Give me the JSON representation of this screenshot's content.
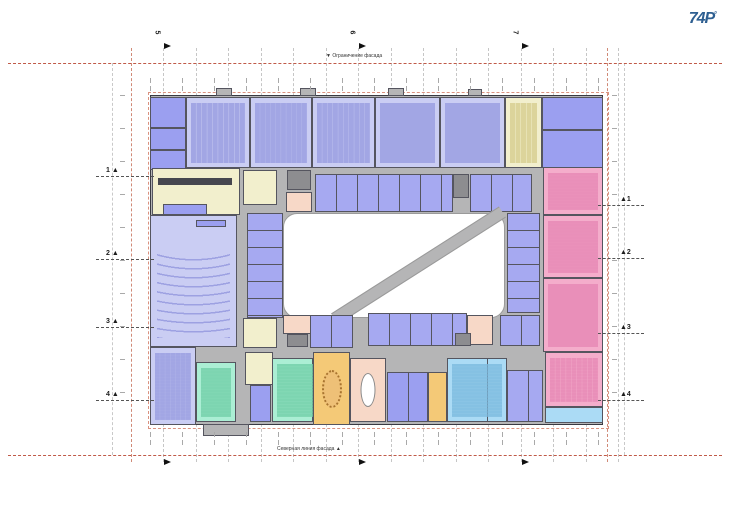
{
  "logo": {
    "text": "74P",
    "sup": "°",
    "color": "#2e5f91"
  },
  "labels": {
    "top_facade": "Ограничение фасада",
    "bottom_facade": "Северная линия фасада"
  },
  "palette": {
    "base": "#b5b5b6",
    "wall": "#55555f",
    "court": "#ffffff",
    "lavender": "#cacdf3",
    "lavDesk": "#989ce0",
    "purple": "#9b9ff0",
    "office": "#a6a9f1",
    "yellow": "#f2efcd",
    "yellowSpeck": "#d6cd8e",
    "salmon": "#f7d8c7",
    "pink": "#f4adcb",
    "pinkDesk": "#e687b4",
    "green": "#abeed4",
    "greenSpeck": "#72cfa8",
    "orange": "#f4c977",
    "blue": "#abdbf5",
    "blueSpeck": "#7cbade",
    "core": "#8d8d90",
    "darkbar": "#47474f",
    "redline": "#c05a48",
    "redlight": "#d08a77",
    "grid": "#c6c6c6",
    "marker": "#1c1c1c"
  },
  "grid": {
    "v_gray": [
      163,
      196,
      228,
      261,
      293,
      326,
      358,
      391,
      423,
      456,
      488,
      521,
      553,
      586,
      618
    ],
    "v_red": [
      131,
      607
    ],
    "v_outer": [
      112,
      624
    ],
    "h_red": [
      63,
      455
    ],
    "red_rect": {
      "x": 148,
      "y": 92,
      "w": 459,
      "h": 335
    },
    "tick_strips_h": [
      {
        "x": 150,
        "y": 78,
        "w": 455
      },
      {
        "x": 150,
        "y": 86,
        "w": 455
      },
      {
        "x": 150,
        "y": 432,
        "w": 455
      },
      {
        "x": 150,
        "y": 440,
        "w": 455
      }
    ],
    "tick_strips_v": [
      {
        "x": 120,
        "y": 95,
        "h": 330
      },
      {
        "x": 612,
        "y": 95,
        "h": 330
      }
    ]
  },
  "markers": {
    "left": [
      {
        "n": "1",
        "y": 176
      },
      {
        "n": "2",
        "y": 259
      },
      {
        "n": "3",
        "y": 327
      },
      {
        "n": "4",
        "y": 400
      }
    ],
    "right": [
      {
        "n": "1",
        "y": 205
      },
      {
        "n": "2",
        "y": 258
      },
      {
        "n": "3",
        "y": 333
      },
      {
        "n": "4",
        "y": 400
      }
    ],
    "top": [
      {
        "n": "5",
        "x": 163
      },
      {
        "n": "6",
        "x": 358
      },
      {
        "n": "7",
        "x": 521
      }
    ],
    "bottom": [
      {
        "x": 163
      },
      {
        "x": 358
      },
      {
        "x": 521
      }
    ]
  },
  "plan": {
    "rooms": [
      {
        "name": "building-base",
        "x": 150,
        "y": 95,
        "w": 453,
        "h": 330,
        "c": "base",
        "cls": "heavy"
      },
      {
        "name": "porch",
        "x": 216,
        "y": 88,
        "w": 16,
        "h": 8,
        "c": "base",
        "cls": "outline"
      },
      {
        "name": "porch",
        "x": 300,
        "y": 88,
        "w": 16,
        "h": 8,
        "c": "base",
        "cls": "outline"
      },
      {
        "name": "porch",
        "x": 388,
        "y": 88,
        "w": 16,
        "h": 8,
        "c": "base",
        "cls": "outline"
      },
      {
        "name": "porch",
        "x": 468,
        "y": 89,
        "w": 14,
        "h": 7,
        "c": "base",
        "cls": "outline"
      },
      {
        "name": "porch",
        "x": 203,
        "y": 424,
        "w": 46,
        "h": 12,
        "c": "base",
        "cls": "outline"
      },
      {
        "name": "room-nw",
        "x": 150,
        "y": 97,
        "w": 36,
        "h": 31,
        "c": "purple",
        "cls": "outline"
      },
      {
        "name": "room-nw",
        "x": 150,
        "y": 128,
        "w": 36,
        "h": 22,
        "c": "purple",
        "cls": "outline"
      },
      {
        "name": "room-nw",
        "x": 150,
        "y": 150,
        "w": 36,
        "h": 20,
        "c": "purple",
        "cls": "outline"
      },
      {
        "name": "classroom",
        "x": 186,
        "y": 97,
        "w": 64,
        "h": 71,
        "c": "lavender",
        "cls": "outline desks",
        "dk": "lavDesk"
      },
      {
        "name": "classroom",
        "x": 250,
        "y": 97,
        "w": 62,
        "h": 71,
        "c": "lavender",
        "cls": "outline desks",
        "dk": "lavDesk"
      },
      {
        "name": "classroom",
        "x": 312,
        "y": 97,
        "w": 63,
        "h": 71,
        "c": "lavender",
        "cls": "outline desks",
        "dk": "lavDesk"
      },
      {
        "name": "classroom",
        "x": 375,
        "y": 97,
        "w": 65,
        "h": 71,
        "c": "lavender",
        "cls": "outline desks",
        "dk": "lavDesk"
      },
      {
        "name": "classroom",
        "x": 440,
        "y": 97,
        "w": 65,
        "h": 71,
        "c": "lavender",
        "cls": "outline desks",
        "dk": "lavDesk"
      },
      {
        "name": "room-yellow",
        "x": 505,
        "y": 97,
        "w": 37,
        "h": 71,
        "c": "yellow",
        "cls": "outline desks",
        "dk": "yellowSpeck"
      },
      {
        "name": "room-ne",
        "x": 542,
        "y": 97,
        "w": 61,
        "h": 33,
        "c": "purple",
        "cls": "outline"
      },
      {
        "name": "room-ne",
        "x": 542,
        "y": 130,
        "w": 61,
        "h": 38,
        "c": "purple",
        "cls": "outline"
      },
      {
        "name": "lobby-yellow",
        "x": 152,
        "y": 168,
        "w": 88,
        "h": 47,
        "c": "yellow",
        "cls": "outline"
      },
      {
        "name": "reception-desk",
        "x": 158,
        "y": 178,
        "w": 74,
        "h": 7,
        "c": "darkbar",
        "cls": ""
      },
      {
        "name": "room-yellow",
        "x": 243,
        "y": 170,
        "w": 34,
        "h": 35,
        "c": "yellow",
        "cls": "outline"
      },
      {
        "name": "stair-core",
        "x": 287,
        "y": 170,
        "w": 24,
        "h": 20,
        "c": "core",
        "cls": "outline"
      },
      {
        "name": "room-salmon",
        "x": 286,
        "y": 192,
        "w": 26,
        "h": 20,
        "c": "salmon",
        "cls": "outline"
      },
      {
        "name": "office-row",
        "x": 315,
        "y": 174,
        "w": 138,
        "h": 38,
        "c": "office",
        "cls": "outline colsA"
      },
      {
        "name": "stair-core",
        "x": 453,
        "y": 174,
        "w": 16,
        "h": 24,
        "c": "core",
        "cls": "outline"
      },
      {
        "name": "office-row",
        "x": 470,
        "y": 174,
        "w": 62,
        "h": 38,
        "c": "office",
        "cls": "outline colsA"
      },
      {
        "name": "stair-core",
        "x": 558,
        "y": 170,
        "w": 24,
        "h": 18,
        "c": "core",
        "cls": "outline"
      },
      {
        "name": "room-salmon",
        "x": 563,
        "y": 190,
        "w": 27,
        "h": 22,
        "c": "salmon",
        "cls": "outline"
      },
      {
        "name": "auditorium",
        "x": 150,
        "y": 215,
        "w": 87,
        "h": 132,
        "c": "lavender",
        "cls": "outline auditorium",
        "dk": "lavDesk"
      },
      {
        "name": "stage-tables",
        "x": 163,
        "y": 204,
        "w": 44,
        "h": 11,
        "c": "purple",
        "cls": "outline"
      },
      {
        "name": "stage-tables",
        "x": 196,
        "y": 220,
        "w": 30,
        "h": 7,
        "c": "purple",
        "cls": "outline"
      },
      {
        "name": "office-column",
        "x": 247,
        "y": 213,
        "w": 36,
        "h": 105,
        "c": "office",
        "cls": "outline rowsA"
      },
      {
        "name": "courtyard",
        "x": 283,
        "y": 213,
        "w": 222,
        "h": 105,
        "c": "court",
        "cls": "courtyard"
      },
      {
        "name": "courtyard-path",
        "x": 319,
        "y": 259,
        "w": 199,
        "h": 13,
        "c": "base",
        "cls": "diag",
        "rot": -32.5
      },
      {
        "name": "office-column",
        "x": 507,
        "y": 213,
        "w": 33,
        "h": 100,
        "c": "office",
        "cls": "outline rowsA"
      },
      {
        "name": "classroom-pink",
        "x": 543,
        "y": 167,
        "w": 60,
        "h": 48,
        "c": "pink",
        "cls": "outline desks",
        "dk": "pinkDesk"
      },
      {
        "name": "classroom-pink",
        "x": 543,
        "y": 215,
        "w": 60,
        "h": 63,
        "c": "pink",
        "cls": "outline desks",
        "dk": "pinkDesk"
      },
      {
        "name": "classroom-pink",
        "x": 543,
        "y": 278,
        "w": 60,
        "h": 74,
        "c": "pink",
        "cls": "outline desks",
        "dk": "pinkDesk"
      },
      {
        "name": "room-sw",
        "x": 150,
        "y": 347,
        "w": 46,
        "h": 78,
        "c": "lavender",
        "cls": "outline desks",
        "dk": "lavDesk"
      },
      {
        "name": "room-green",
        "x": 196,
        "y": 362,
        "w": 40,
        "h": 60,
        "c": "green",
        "cls": "outline desks",
        "dk": "greenSpeck"
      },
      {
        "name": "room-yellow",
        "x": 245,
        "y": 352,
        "w": 28,
        "h": 33,
        "c": "yellow",
        "cls": "outline"
      },
      {
        "name": "room-purple",
        "x": 250,
        "y": 385,
        "w": 21,
        "h": 37,
        "c": "purple",
        "cls": "outline"
      },
      {
        "name": "room-green",
        "x": 272,
        "y": 358,
        "w": 80,
        "h": 64,
        "c": "green",
        "cls": "outline desks colsB",
        "dk": "greenSpeck"
      },
      {
        "name": "office-row",
        "x": 310,
        "y": 315,
        "w": 43,
        "h": 33,
        "c": "office",
        "cls": "outline colsA"
      },
      {
        "name": "room-yellow",
        "x": 243,
        "y": 318,
        "w": 34,
        "h": 30,
        "c": "yellow",
        "cls": "outline"
      },
      {
        "name": "room-salmon",
        "x": 283,
        "y": 315,
        "w": 28,
        "h": 19,
        "c": "salmon",
        "cls": "outline"
      },
      {
        "name": "stair-core",
        "x": 287,
        "y": 334,
        "w": 21,
        "h": 13,
        "c": "core",
        "cls": "outline"
      },
      {
        "name": "office-row",
        "x": 368,
        "y": 313,
        "w": 99,
        "h": 33,
        "c": "office",
        "cls": "outline colsA"
      },
      {
        "name": "room-salmon",
        "x": 467,
        "y": 315,
        "w": 26,
        "h": 30,
        "c": "salmon",
        "cls": "outline"
      },
      {
        "name": "office-row",
        "x": 500,
        "y": 315,
        "w": 40,
        "h": 31,
        "c": "office",
        "cls": "outline colsA"
      },
      {
        "name": "stair-core",
        "x": 455,
        "y": 333,
        "w": 16,
        "h": 13,
        "c": "core",
        "cls": "outline"
      },
      {
        "name": "hall-orange",
        "x": 313,
        "y": 352,
        "w": 37,
        "h": 73,
        "c": "orange",
        "cls": "outline oval-table"
      },
      {
        "name": "stair-hall",
        "x": 350,
        "y": 358,
        "w": 36,
        "h": 64,
        "c": "salmon",
        "cls": "outline oval-stair"
      },
      {
        "name": "office-row",
        "x": 387,
        "y": 372,
        "w": 41,
        "h": 50,
        "c": "purple",
        "cls": "outline colsA"
      },
      {
        "name": "room-orange",
        "x": 428,
        "y": 372,
        "w": 19,
        "h": 50,
        "c": "orange",
        "cls": "outline"
      },
      {
        "name": "room-blue",
        "x": 447,
        "y": 358,
        "w": 60,
        "h": 64,
        "c": "blue",
        "cls": "outline desks colsB",
        "dk": "blueSpeck"
      },
      {
        "name": "office-row",
        "x": 507,
        "y": 370,
        "w": 36,
        "h": 52,
        "c": "office",
        "cls": "outline colsA"
      },
      {
        "name": "classroom-pink",
        "x": 545,
        "y": 352,
        "w": 58,
        "h": 55,
        "c": "pink",
        "cls": "outline desks",
        "dk": "pinkDesk"
      },
      {
        "name": "room-blue",
        "x": 545,
        "y": 407,
        "w": 58,
        "h": 16,
        "c": "blue",
        "cls": "outline"
      }
    ]
  }
}
